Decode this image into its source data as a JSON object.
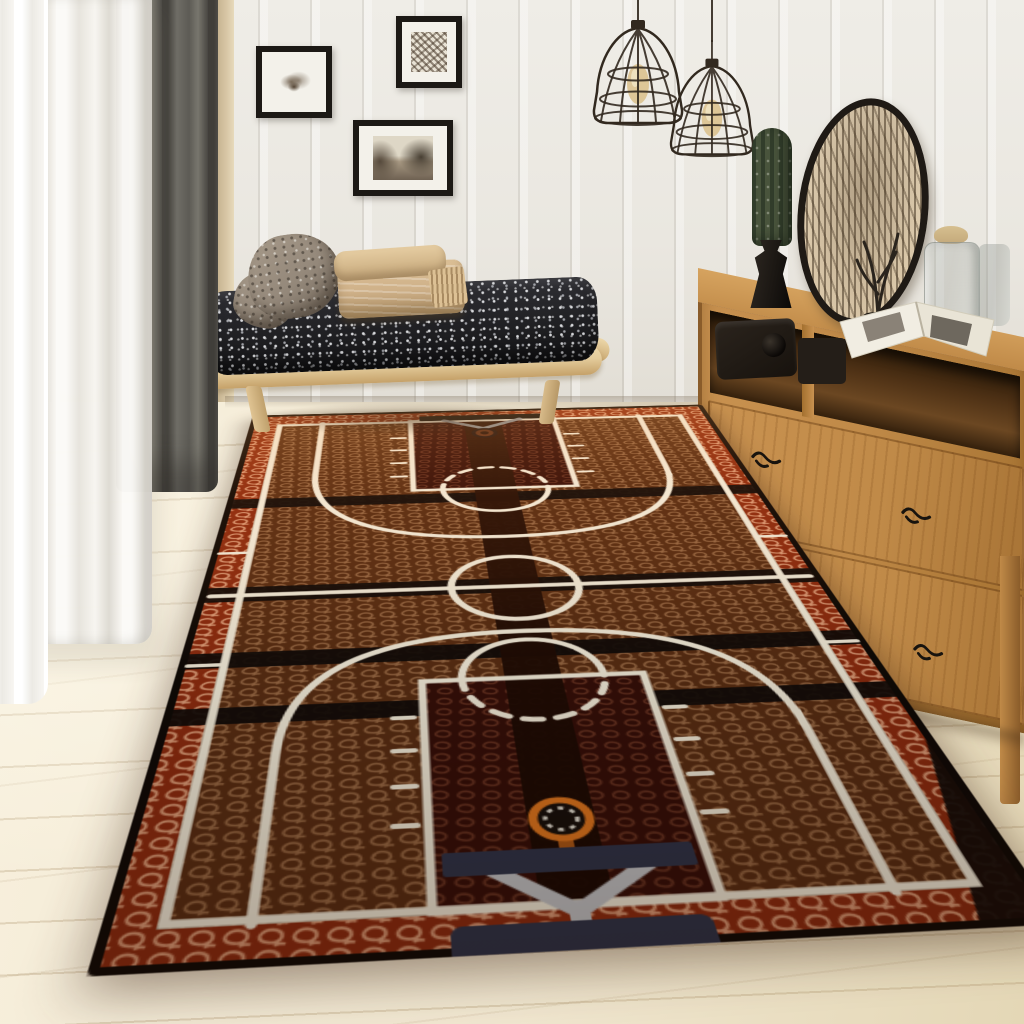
{
  "meta": {
    "type": "photograph",
    "aria_label": "Bedroom corner with a basketball court area rug",
    "description": "Interior photo: white plank wall, framed art, wire pendant lights, wood daybed with speckled cushion, oak sideboard with decor, and a large basketball-court themed rug on a light wood floor"
  },
  "scene": {
    "wall": {
      "label": "white vertical plank wall"
    },
    "window": {
      "label": "window with curtains",
      "curtains": [
        "white sheer curtain",
        "gray curtain panel"
      ]
    },
    "gallery": {
      "frames": [
        {
          "label": "framed coral sketch"
        },
        {
          "label": "framed botanical print"
        },
        {
          "label": "framed landscape photograph"
        }
      ]
    },
    "lights": {
      "label": "wire cage pendant lights",
      "count": 2
    },
    "daybed": {
      "label": "light wood daybed",
      "cushion": "black and white speckled cushion",
      "pillow": "taupe textured pillow",
      "blankets": "folded tan blankets with fringe"
    },
    "sideboard": {
      "label": "oak sideboard with open shelf and drawers",
      "handles": 4
    },
    "decor": {
      "cactus": "column cactus in black urn pot",
      "oval_art": "oval botanical artwork leaning on wall",
      "jar": "lidded glass jar",
      "bottle": "glass bottle",
      "sculpture": "dark twig sculpture",
      "book": "open picture book",
      "camera": "dark camera and box on shelf"
    },
    "rug": {
      "label": "basketball court area rug",
      "texture": "basketball pebble-grain with mesh pattern",
      "elements": [
        "black binding edge",
        "orange out-of-bounds border",
        "white boundary line",
        "midcourt line",
        "center circle",
        "dark center stripe",
        "black accent bands",
        "free-throw keys",
        "solid and dashed free-throw arcs",
        "three-point arcs",
        "lane hash marks",
        "sideline ticks",
        "orange hoop rim with net",
        "navy backboard and base",
        "gray hoop support arms"
      ]
    }
  },
  "colors": {
    "wall": "#eae7e0",
    "wall-line": "rgba(95,88,76,0.12)",
    "trim": "#d8c7a6",
    "floor": "#f0e6cf",
    "floor-line": "rgba(166,139,98,0.28)",
    "sheer": "#f7f5f0",
    "curtain": "#5d5b55",
    "curtain-dark": "#44423d",
    "frame": "#1c1915",
    "mat": "#f3f1ea",
    "wire": "#32291f",
    "bulb": "#dbc290",
    "bed-wood": "#e4cc9c",
    "bed-wood-dark": "#c5a169",
    "mattress": "#202023",
    "speckle": "#d8d9dc",
    "pillow": "#94887a",
    "blanket": "#cfb189",
    "blanket-dark": "#ab8d63",
    "cactus": "#49543c",
    "cactus-dark": "#323d2b",
    "pot": "#1b1713",
    "oval-bg": "#d8c5a6",
    "glass": "rgba(186,192,186,0.45)",
    "lid": "#c3a97b",
    "cab": "#c08a48",
    "cab-top": "#d6a35f",
    "cab-shelf": "#4e3115",
    "cab-edge": "#7c5222",
    "rug-edge": "#100a06",
    "border-base": "#8e2c0f",
    "border-mesh": "#efb28b",
    "court-base": "#5a2e13",
    "court-mesh": "#c89468",
    "key-base": "#360f08",
    "key-mesh": "#8d4c34",
    "stripe-a": "#2e1307",
    "stripe-b": "#1a0903",
    "band": "#120c08",
    "line": "#f4ecd9",
    "rim": "#e2771e",
    "navy": "#2f3449",
    "support": "#c3c4c6",
    "shadow": "rgba(70,50,30,0.45)"
  }
}
